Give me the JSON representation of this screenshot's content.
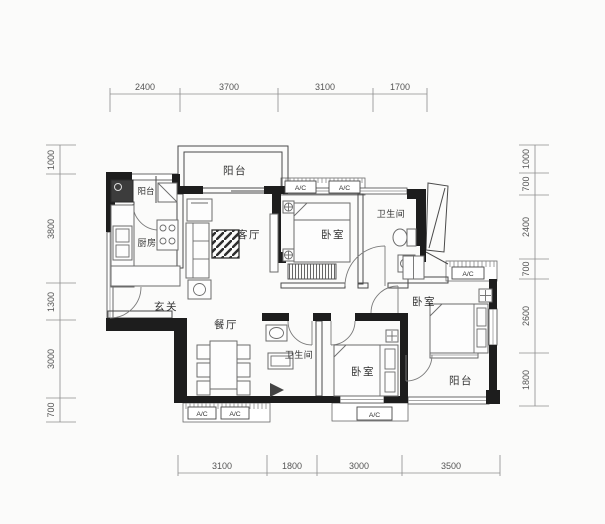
{
  "dims": {
    "top": [
      "2400",
      "3700",
      "3100",
      "1700"
    ],
    "bottom": [
      "3100",
      "1800",
      "3000",
      "3500"
    ],
    "left": [
      "1000",
      "3800",
      "1300",
      "3000",
      "700"
    ],
    "right": [
      "1000",
      "700",
      "2400",
      "700",
      "2600",
      "1800"
    ]
  },
  "rooms": {
    "balcony_left": "阳台",
    "balcony_top": "阳台",
    "kitchen": "厨房",
    "living": "客厅",
    "bedroom_top": "卧室",
    "bath_top": "卫生间",
    "foyer": "玄关",
    "dining": "餐厅",
    "bath_bottom": "卫生间",
    "bedroom_bottom": "卧室",
    "bedroom_right": "卧室",
    "balcony_bottom": "阳台"
  },
  "ac_label": "A/C",
  "colors": {
    "wall": "#1d1d1d",
    "line": "#4a4a4a",
    "dim_text": "#555555",
    "background": "#fbfbfa"
  }
}
